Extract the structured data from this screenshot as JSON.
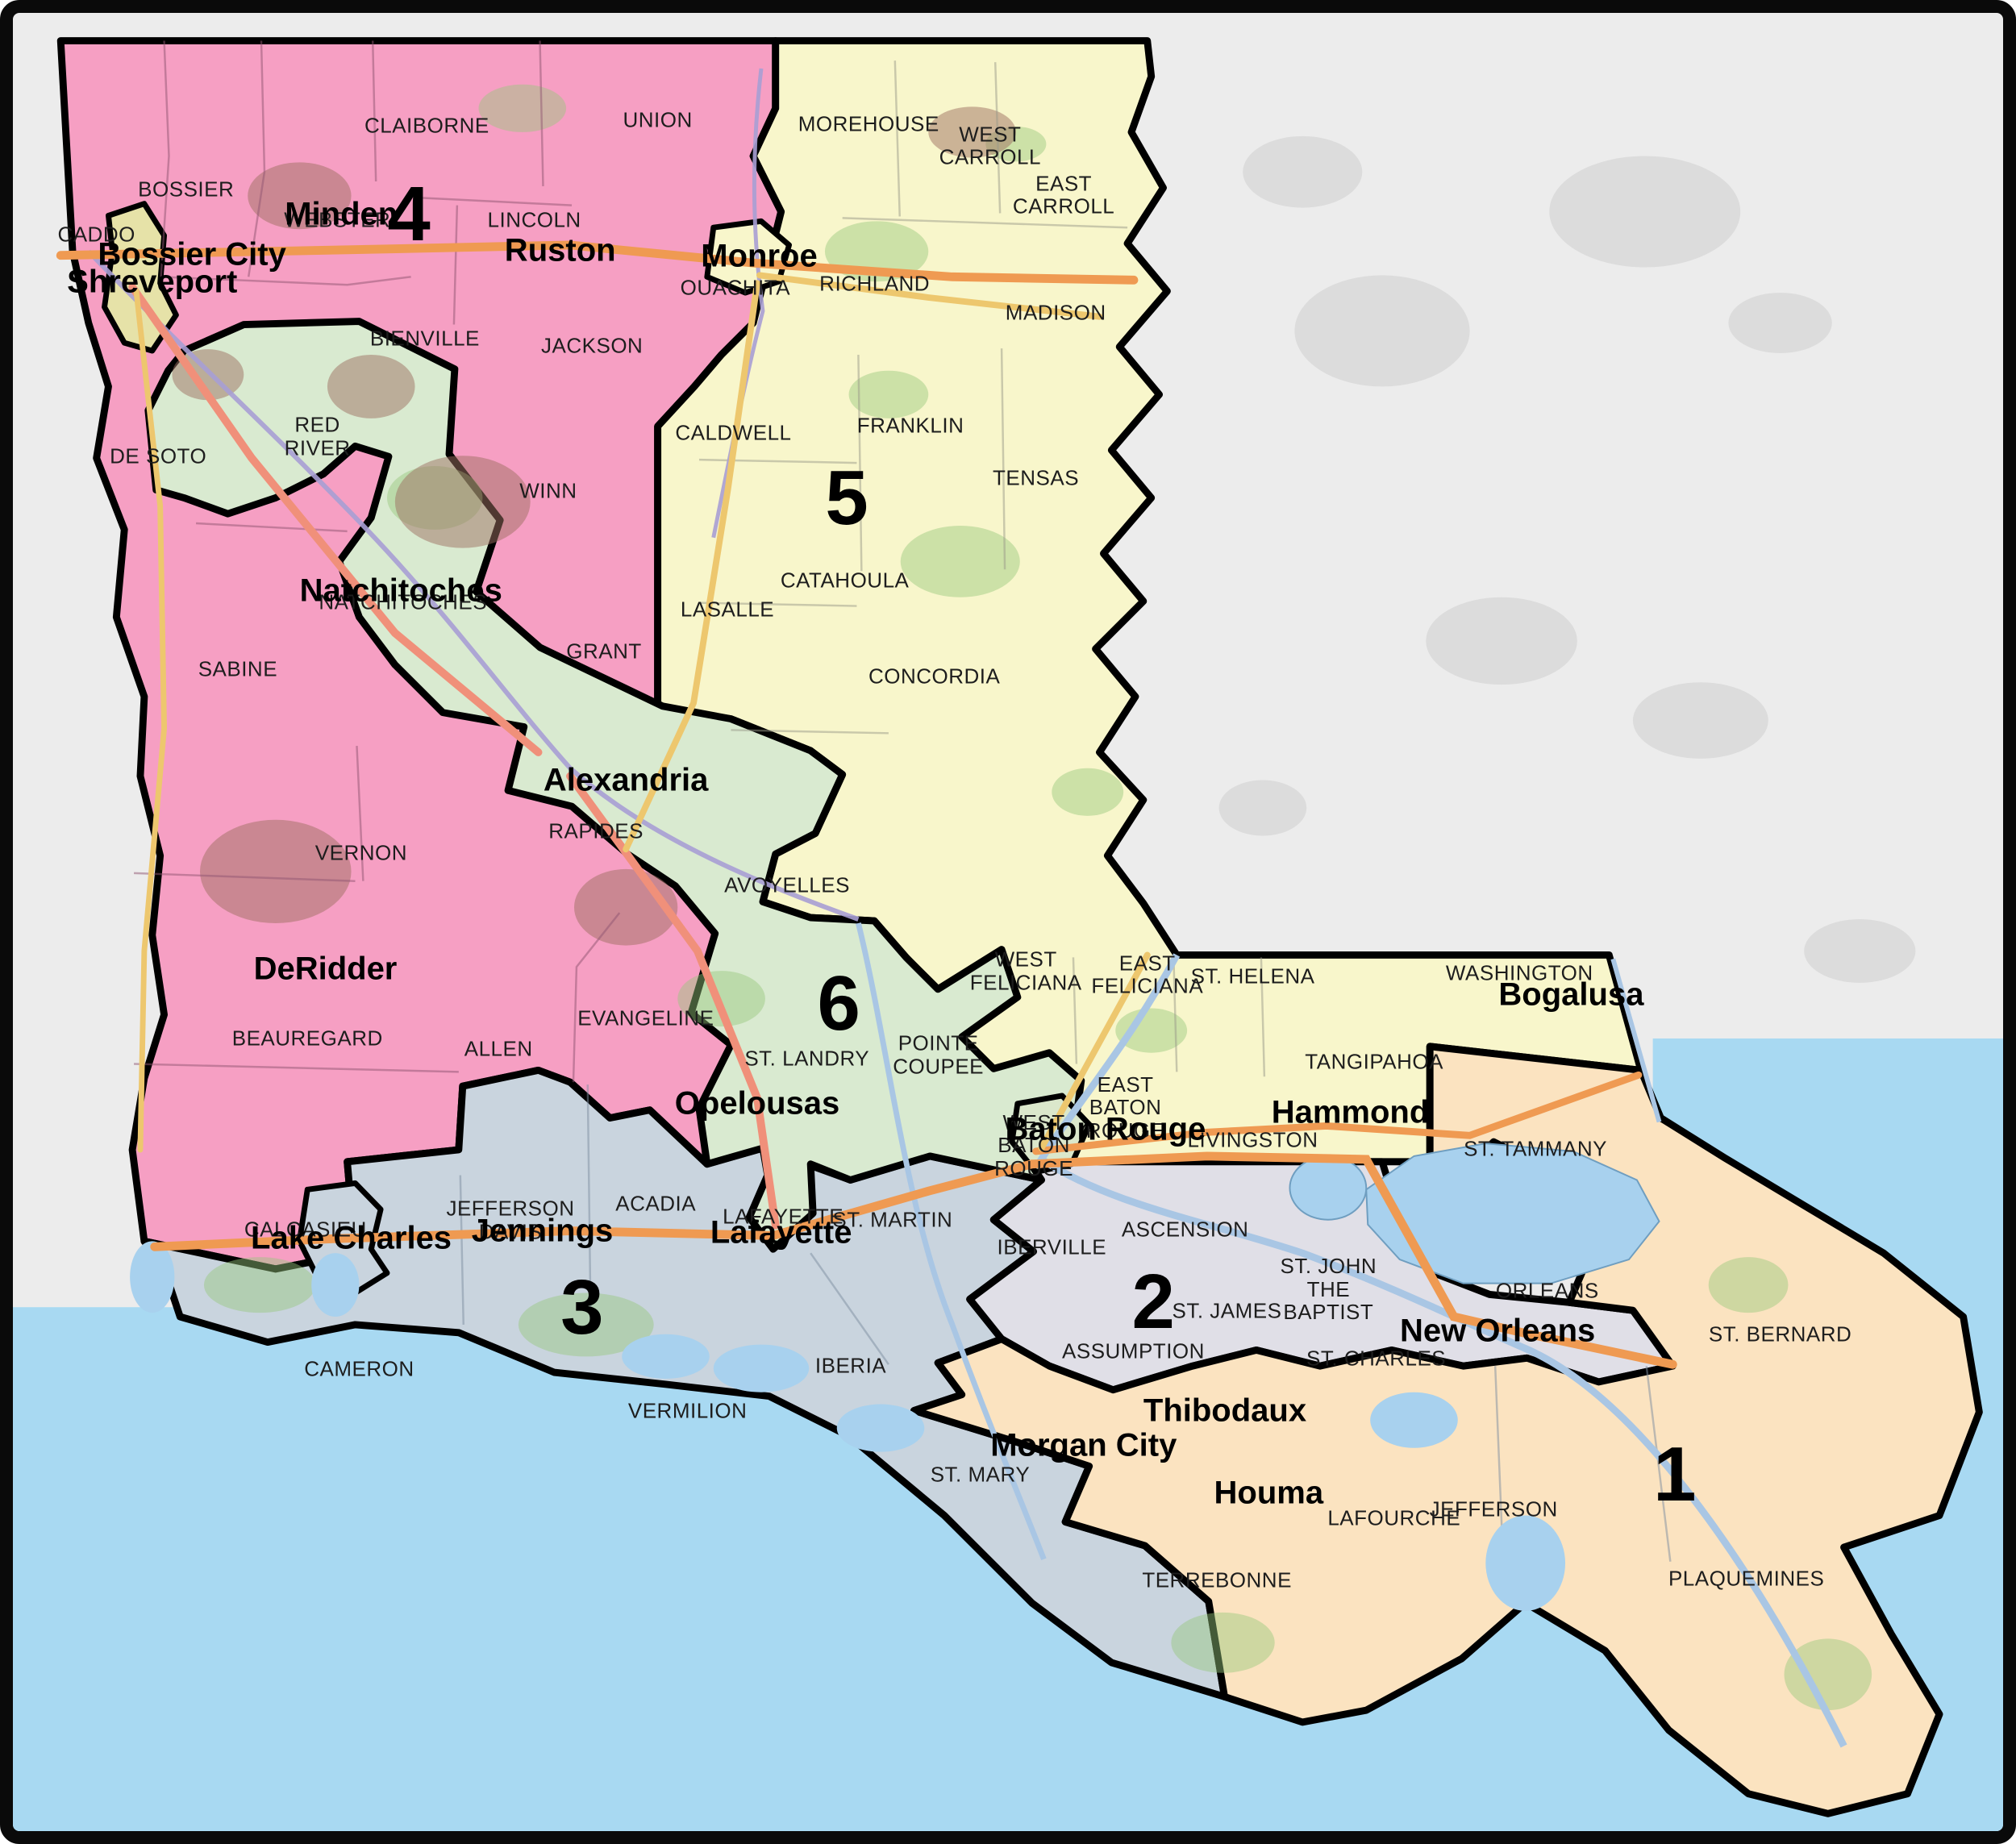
{
  "map_title": "Louisiana congressional districts",
  "colors": {
    "district_1": "#fbe3c0",
    "district_2": "#e0dfe7",
    "district_3": "#c9d4de",
    "district_4": "#f69fc3",
    "district_5": "#f8f6cb",
    "district_6": "#d9ead0",
    "gulf_water": "#a8d9f2",
    "lake_water": "#a8d1ee",
    "outside_land": "#ececec",
    "outside_patch": "#dcdcdc",
    "boundary": "#000000",
    "urban_shreveport": "#e6e2a8",
    "urban_baton_rouge": "#dbe7cb"
  },
  "district_numbers": [
    {
      "n": "4",
      "x": 19.9,
      "y": 11.1
    },
    {
      "n": "5",
      "x": 41.9,
      "y": 26.7
    },
    {
      "n": "6",
      "x": 41.5,
      "y": 54.5
    },
    {
      "n": "3",
      "x": 28.6,
      "y": 71.2
    },
    {
      "n": "2",
      "x": 57.3,
      "y": 70.9
    },
    {
      "n": "1",
      "x": 83.5,
      "y": 80.4
    }
  ],
  "cities": [
    {
      "name": "Minden",
      "x": 16.5,
      "y": 11.1
    },
    {
      "name": "Bossier City",
      "x": 9.0,
      "y": 13.3
    },
    {
      "name": "Shreveport",
      "x": 7.0,
      "y": 14.8
    },
    {
      "name": "Ruston",
      "x": 27.5,
      "y": 13.1
    },
    {
      "name": "Monroe",
      "x": 37.5,
      "y": 13.4
    },
    {
      "name": "Natchitoches",
      "x": 19.5,
      "y": 31.8
    },
    {
      "name": "Alexandria",
      "x": 30.8,
      "y": 42.2
    },
    {
      "name": "DeRidder",
      "x": 15.7,
      "y": 52.6
    },
    {
      "name": "Opelousas",
      "x": 37.4,
      "y": 60.0
    },
    {
      "name": "Lake Charles",
      "x": 17.0,
      "y": 67.4
    },
    {
      "name": "Jennings",
      "x": 26.6,
      "y": 67.0
    },
    {
      "name": "Lafayette",
      "x": 38.6,
      "y": 67.1
    },
    {
      "name": "Baton Rouge",
      "x": 54.9,
      "y": 61.4
    },
    {
      "name": "Hammond",
      "x": 67.2,
      "y": 60.5
    },
    {
      "name": "Bogalusa",
      "x": 78.3,
      "y": 54.0
    },
    {
      "name": "Thibodaux",
      "x": 60.9,
      "y": 76.9
    },
    {
      "name": "Morgan City",
      "x": 53.8,
      "y": 78.8
    },
    {
      "name": "Houma",
      "x": 63.1,
      "y": 81.4
    },
    {
      "name": "New Orleans",
      "x": 74.6,
      "y": 72.5
    }
  ],
  "parishes": [
    {
      "name": "CADDO",
      "x": 4.2,
      "y": 12.2
    },
    {
      "name": "BOSSIER",
      "x": 8.7,
      "y": 9.7
    },
    {
      "name": "WEBSTER",
      "x": 16.3,
      "y": 11.4
    },
    {
      "name": "CLAIBORNE",
      "x": 20.8,
      "y": 6.2
    },
    {
      "name": "UNION",
      "x": 32.4,
      "y": 5.9
    },
    {
      "name": "MOREHOUSE",
      "x": 43.0,
      "y": 6.1
    },
    {
      "name": "WEST\nCARROLL",
      "x": 49.1,
      "y": 7.3
    },
    {
      "name": "EAST\nCARROLL",
      "x": 52.8,
      "y": 10.0
    },
    {
      "name": "LINCOLN",
      "x": 26.2,
      "y": 11.4
    },
    {
      "name": "OUACHITA",
      "x": 36.3,
      "y": 15.1
    },
    {
      "name": "RICHLAND",
      "x": 43.3,
      "y": 14.9
    },
    {
      "name": "MADISON",
      "x": 52.4,
      "y": 16.5
    },
    {
      "name": "BIENVILLE",
      "x": 20.7,
      "y": 17.9
    },
    {
      "name": "JACKSON",
      "x": 29.1,
      "y": 18.3
    },
    {
      "name": "RED\nRIVER",
      "x": 15.3,
      "y": 23.3
    },
    {
      "name": "DE SOTO",
      "x": 7.3,
      "y": 24.4
    },
    {
      "name": "WINN",
      "x": 26.9,
      "y": 26.3
    },
    {
      "name": "CALDWELL",
      "x": 36.2,
      "y": 23.1
    },
    {
      "name": "FRANKLIN",
      "x": 45.1,
      "y": 22.7
    },
    {
      "name": "TENSAS",
      "x": 51.4,
      "y": 25.6
    },
    {
      "name": "SABINE",
      "x": 11.3,
      "y": 36.1
    },
    {
      "name": "NATCHITOCHES",
      "x": 19.6,
      "y": 32.4
    },
    {
      "name": "GRANT",
      "x": 29.7,
      "y": 35.1
    },
    {
      "name": "LASALLE",
      "x": 35.9,
      "y": 32.8
    },
    {
      "name": "CATAHOULA",
      "x": 41.8,
      "y": 31.2
    },
    {
      "name": "CONCORDIA",
      "x": 46.3,
      "y": 36.5
    },
    {
      "name": "RAPIDES",
      "x": 29.3,
      "y": 45.0
    },
    {
      "name": "AVOYELLES",
      "x": 38.9,
      "y": 48.0
    },
    {
      "name": "VERNON",
      "x": 17.5,
      "y": 46.2
    },
    {
      "name": "BEAUREGARD",
      "x": 14.8,
      "y": 56.4
    },
    {
      "name": "ALLEN",
      "x": 24.4,
      "y": 57.0
    },
    {
      "name": "EVANGELINE",
      "x": 31.8,
      "y": 55.3
    },
    {
      "name": "ST. LANDRY",
      "x": 39.9,
      "y": 57.5
    },
    {
      "name": "POINTE\nCOUPEE",
      "x": 46.5,
      "y": 57.3
    },
    {
      "name": "WEST\nFELICIANA",
      "x": 50.9,
      "y": 52.7
    },
    {
      "name": "EAST\nFELICIANA",
      "x": 57.0,
      "y": 52.9
    },
    {
      "name": "ST. HELENA",
      "x": 62.3,
      "y": 53.0
    },
    {
      "name": "WASHINGTON",
      "x": 75.7,
      "y": 52.8
    },
    {
      "name": "TANGIPAHOA",
      "x": 68.4,
      "y": 57.7
    },
    {
      "name": "LIVINGSTON",
      "x": 62.3,
      "y": 62.0
    },
    {
      "name": "ST. TAMMANY",
      "x": 76.5,
      "y": 62.5
    },
    {
      "name": "WEST\nBATON\nROUGE",
      "x": 51.3,
      "y": 62.3
    },
    {
      "name": "EAST\nBATON\nROUGE",
      "x": 55.9,
      "y": 60.2
    },
    {
      "name": "IBERVILLE",
      "x": 52.2,
      "y": 67.9
    },
    {
      "name": "ASCENSION",
      "x": 58.9,
      "y": 66.9
    },
    {
      "name": "CALCASIEU",
      "x": 14.7,
      "y": 66.9
    },
    {
      "name": "JEFFERSON\nDAVIS",
      "x": 25.0,
      "y": 66.4
    },
    {
      "name": "ACADIA",
      "x": 32.3,
      "y": 65.5
    },
    {
      "name": "LAFAYETTE",
      "x": 38.7,
      "y": 66.2
    },
    {
      "name": "ST. MARTIN",
      "x": 44.2,
      "y": 66.4
    },
    {
      "name": "CAMERON",
      "x": 17.4,
      "y": 74.6
    },
    {
      "name": "VERMILION",
      "x": 33.9,
      "y": 76.9
    },
    {
      "name": "IBERIA",
      "x": 42.1,
      "y": 74.4
    },
    {
      "name": "ST. JAMES",
      "x": 61.0,
      "y": 71.4
    },
    {
      "name": "ST. JOHN\nTHE\nBAPTIST",
      "x": 66.1,
      "y": 70.2
    },
    {
      "name": "ASSUMPTION",
      "x": 56.3,
      "y": 73.6
    },
    {
      "name": "ST. CHARLES",
      "x": 68.5,
      "y": 74.0
    },
    {
      "name": "ORLEANS",
      "x": 77.1,
      "y": 70.3
    },
    {
      "name": "ST. BERNARD",
      "x": 88.8,
      "y": 72.7
    },
    {
      "name": "ST. MARY",
      "x": 48.6,
      "y": 80.4
    },
    {
      "name": "LAFOURCHE",
      "x": 69.4,
      "y": 82.8
    },
    {
      "name": "JEFFERSON",
      "x": 74.4,
      "y": 82.3
    },
    {
      "name": "TERREBONNE",
      "x": 60.5,
      "y": 86.2
    },
    {
      "name": "PLAQUEMINES",
      "x": 87.1,
      "y": 86.1
    }
  ]
}
